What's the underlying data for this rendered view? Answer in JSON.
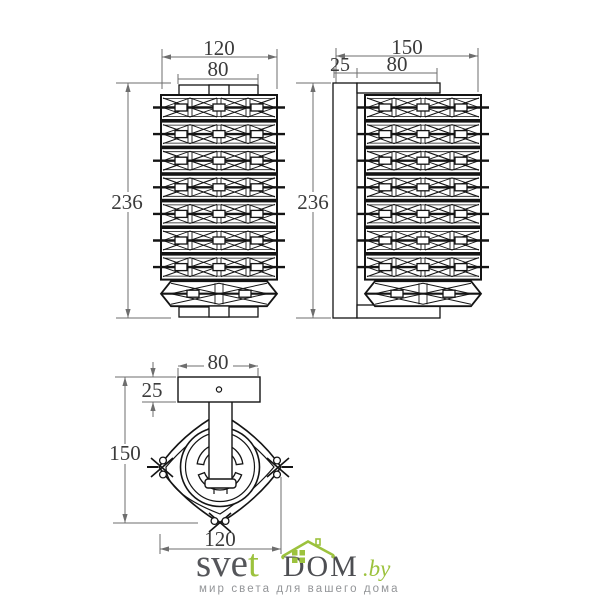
{
  "drawing": {
    "front": {
      "width": "120",
      "mount_width": "80",
      "height": "236"
    },
    "side": {
      "depth": "150",
      "plate_depth": "25",
      "body_offset": "80",
      "height": "236"
    },
    "top": {
      "mount_width": "80",
      "plate_depth": "25",
      "total_depth": "150",
      "body_width": "120"
    }
  },
  "watermark": {
    "brand_sve": "sve",
    "brand_t": "t",
    "brand_dom": "DOM",
    "brand_by": ".by",
    "tagline": "мир света для вашего дома",
    "green": "#9cc23d",
    "gray": "#55565a",
    "tagline_gray": "#939598"
  }
}
